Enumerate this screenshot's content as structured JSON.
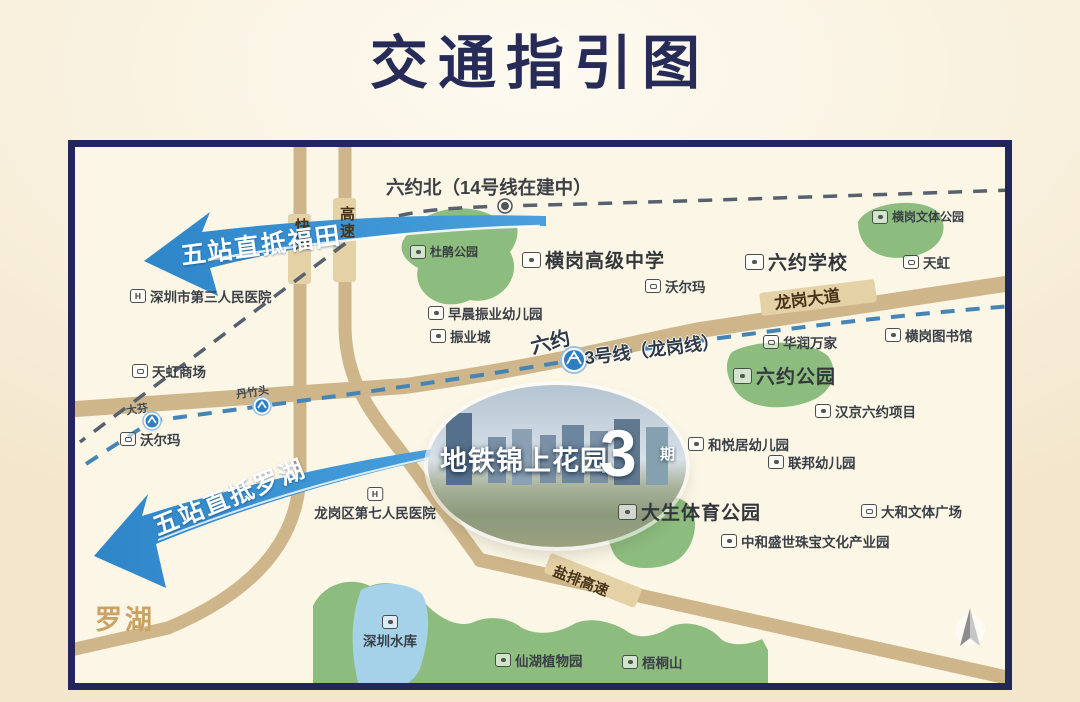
{
  "title": "交通指引图",
  "map": {
    "arrows": [
      {
        "text": "五站直抵福田"
      },
      {
        "text": "五站直抵罗湖"
      }
    ],
    "metro": {
      "line14_station_label": "六约北（14号线在建中）",
      "line3_label": "3号线（龙岗线）",
      "station_liuyue": "六约",
      "station_danzhutou": "丹竹头",
      "station_dafen": "大芬"
    },
    "roads": {
      "longgang_avenue": "龙岗大道",
      "yanpai_expressway": "盐排高速",
      "expressway_kuaisu": "快速",
      "expressway_gaosu": "高速"
    },
    "district_label": "罗湖",
    "property": {
      "name": "地铁锦上花园",
      "phase_number": "3",
      "phase_unit": "期"
    },
    "pois": [
      {
        "label": "杜鹃公园",
        "type": "park",
        "variant": "small",
        "x": 342,
        "y": 103
      },
      {
        "label": "横岗文体公园",
        "type": "park",
        "variant": "small",
        "x": 804,
        "y": 68
      },
      {
        "label": "横岗高级中学",
        "type": "school",
        "variant": "big",
        "x": 454,
        "y": 106
      },
      {
        "label": "六约学校",
        "type": "school",
        "variant": "big",
        "x": 677,
        "y": 108
      },
      {
        "label": "天虹",
        "type": "shop",
        "variant": "normal",
        "x": 835,
        "y": 112
      },
      {
        "label": "沃尔玛",
        "type": "shop",
        "variant": "normal",
        "x": 577,
        "y": 136
      },
      {
        "label": "早晨振业幼儿园",
        "type": "school",
        "variant": "normal",
        "x": 360,
        "y": 163
      },
      {
        "label": "振业城",
        "type": "factory",
        "variant": "normal",
        "x": 362,
        "y": 186
      },
      {
        "label": "华润万家",
        "type": "shop",
        "variant": "normal",
        "x": 695,
        "y": 192
      },
      {
        "label": "横岗图书馆",
        "type": "library",
        "variant": "normal",
        "x": 817,
        "y": 185
      },
      {
        "label": "六约公园",
        "type": "park",
        "variant": "big",
        "x": 665,
        "y": 222
      },
      {
        "label": "汉京六约项目",
        "type": "factory",
        "variant": "normal",
        "x": 747,
        "y": 261
      },
      {
        "label": "和悦居幼儿园",
        "type": "school",
        "variant": "normal",
        "x": 620,
        "y": 294
      },
      {
        "label": "联邦幼儿园",
        "type": "school",
        "variant": "normal",
        "x": 700,
        "y": 312
      },
      {
        "label": "大生体育公园",
        "type": "park",
        "variant": "big",
        "x": 550,
        "y": 358
      },
      {
        "label": "大和文体广场",
        "type": "shop",
        "variant": "normal",
        "x": 793,
        "y": 361
      },
      {
        "label": "中和盛世珠宝文化产业园",
        "type": "factory",
        "variant": "normal",
        "x": 653,
        "y": 391
      },
      {
        "label": "深圳市第三人民医院",
        "type": "hospital",
        "variant": "normal",
        "glyph": "H",
        "x": 62,
        "y": 146
      },
      {
        "label": "天虹商场",
        "type": "shop",
        "variant": "normal",
        "x": 64,
        "y": 221
      },
      {
        "label": "沃尔玛",
        "type": "shop",
        "variant": "normal",
        "x": 52,
        "y": 289
      },
      {
        "label": "龙岗区第七人民医院",
        "type": "hospital",
        "variant": "normal",
        "glyph": "H",
        "stack": true,
        "x": 307,
        "y": 347
      },
      {
        "label": "深圳水库",
        "type": "reservoir",
        "variant": "normal",
        "stack": true,
        "x": 322,
        "y": 475
      },
      {
        "label": "仙湖植物园",
        "type": "park",
        "variant": "normal",
        "x": 427,
        "y": 510
      },
      {
        "label": "梧桐山",
        "type": "park",
        "variant": "normal",
        "x": 554,
        "y": 512
      }
    ]
  }
}
